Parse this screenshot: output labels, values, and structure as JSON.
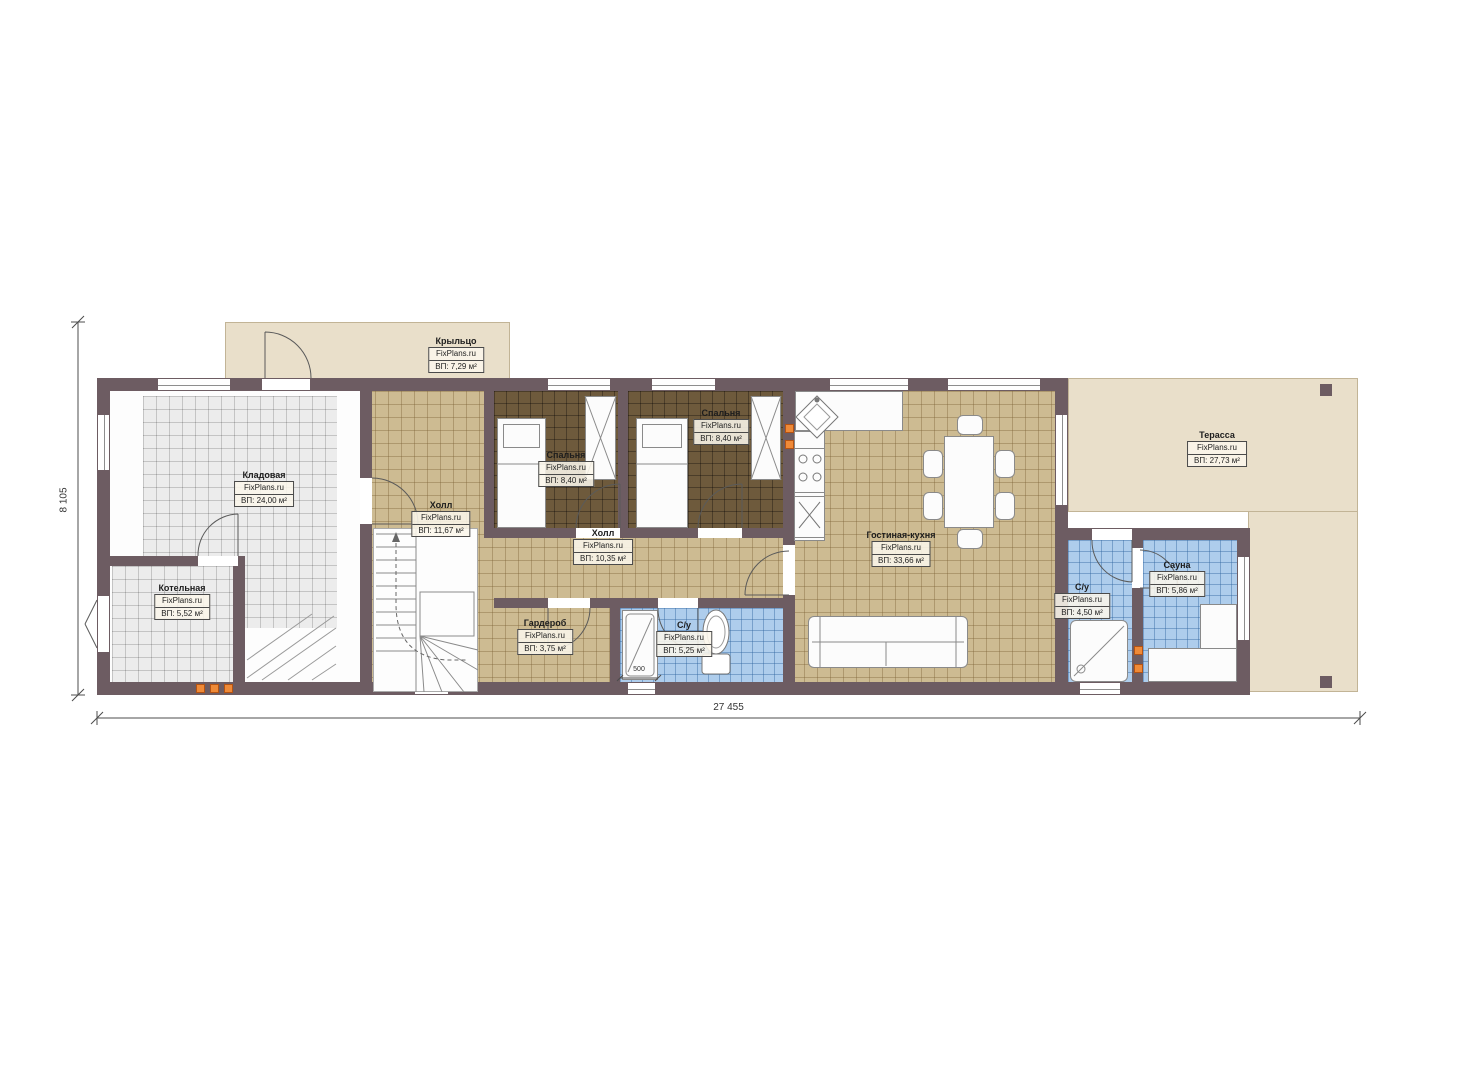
{
  "plan": {
    "brand": "FixPlans.ru",
    "dimensions": {
      "width": "27 455",
      "height": "8 105",
      "door": "500"
    },
    "rooms": [
      {
        "name": "Крыльцо",
        "area": "ВП: 7,29 м²"
      },
      {
        "name": "Кладовая",
        "area": "ВП: 24,00 м²"
      },
      {
        "name": "Котельная",
        "area": "ВП: 5,52 м²"
      },
      {
        "name": "Холл",
        "area": "ВП: 11,67 м²"
      },
      {
        "name": "Спальня",
        "area": "ВП: 8,40 м²"
      },
      {
        "name": "Спальня",
        "area": "ВП: 8,40 м²"
      },
      {
        "name": "Холл",
        "area": "ВП: 10,35 м²"
      },
      {
        "name": "Гостиная-кухня",
        "area": "ВП: 33,66 м²"
      },
      {
        "name": "Гардероб",
        "area": "ВП: 3,75 м²"
      },
      {
        "name": "С/у",
        "area": "ВП: 5,25 м²"
      },
      {
        "name": "С/у",
        "area": "ВП: 4,50 м²"
      },
      {
        "name": "Сауна",
        "area": "ВП: 5,86 м²"
      },
      {
        "name": "Терасса",
        "area": "ВП: 27,73 м²"
      }
    ],
    "colors": {
      "wall": "#6d5c62",
      "floor_tile": "#cdbb92",
      "floor_wood_dark": "#6e5a3c",
      "floor_wet": "#aecdec",
      "floor_utility": "#ececec",
      "deck": "#e9dfca",
      "vent": "#ef8a38"
    }
  }
}
